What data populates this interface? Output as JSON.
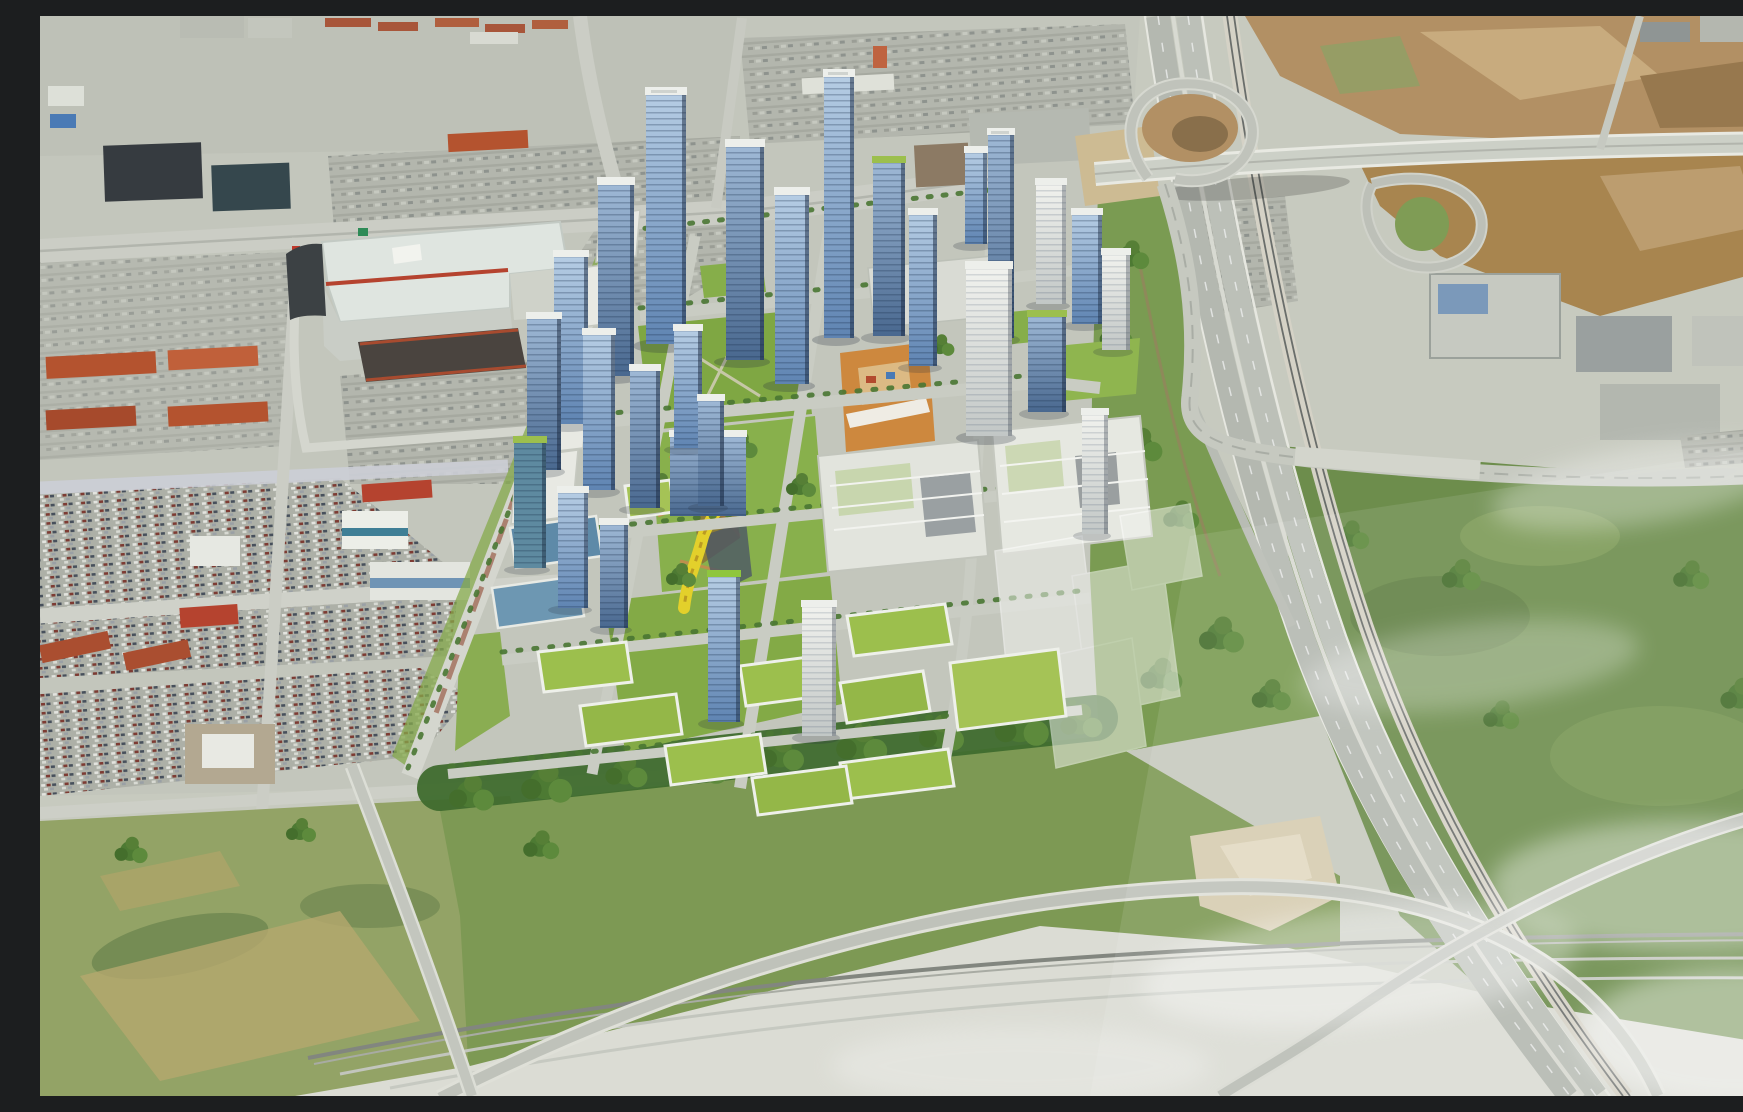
{
  "meta": {
    "title": "Aerial rendering of a transit-oriented master-planned tower development beside a freeway interchange",
    "alt": "Oblique summer aerial view: a photorealistic cluster of blue-glass condo towers, white podium slabs and green-roof mid-rises is composited onto suburban aerial photography. West of the site sit a large shopping mall with a mint roof and red-brick trim, big-box stores and car-filled dealership lots. East, a multi-lane freeway with a parallel rail line sweeps diagonally through loop ramps and brown graded fields. A pale concrete highway corridor with crossing flyover ramps runs along the bottom, with olive meadows lower-left and thin translucent clouds over the south-east."
  },
  "scene": {
    "time_of_day": "midday, summer",
    "style": "photorealistic 3D massing composited onto oblique aerial photo",
    "regions": [
      {
        "id": "suburban-retail-west",
        "label": "Existing suburban retail and parking fabric",
        "description": "Mall with mint roof and red-brick trim, dark big-box roofs, orange/red roofed plazas, dealership lots dense with cars"
      },
      {
        "id": "development-core",
        "label": "Proposed mixed-use development",
        "description": "Blue glass towers with white mechanical caps, long white podium slabs along a transit spine, green-roof mid-rises, central park with yellow ribbon path, orange event plaza with white canopy, translucent future-phase massing blocks"
      },
      {
        "id": "freeway-interchange-east",
        "label": "Freeway corridor and interchange",
        "description": "Twin carriageways plus rail line curving south-east, two loop ramps, arterial bridge, brown graded fields top-right, industrial roofs at right edge"
      },
      {
        "id": "highway-corridor-south",
        "label": "Pale highway corridor",
        "description": "Wide light-concrete corridor crossed by two flyover ramps forming an X"
      },
      {
        "id": "greenfields",
        "label": "Meadows and woodlots",
        "description": "Olive meadow lower-left, dense tree belt south of the site, scrub with sandy clearings near the freeway"
      },
      {
        "id": "clouds",
        "label": "Thin clouds",
        "description": "Wispy translucent cloud streaks over the south-east quadrant"
      }
    ],
    "landmarks": [
      {
        "id": "mall",
        "label": "Shopping mall with mint roof and red trim"
      },
      {
        "id": "orange-plaza",
        "label": "Orange event plaza with white canopy"
      },
      {
        "id": "yellow-ribbon",
        "label": "Yellow ribbon path in central park"
      },
      {
        "id": "tallest-tower",
        "label": "Tallest slender glass tower"
      },
      {
        "id": "loop-ramps",
        "label": "Interchange loop ramps"
      },
      {
        "id": "rail-line",
        "label": "Rail line beside freeway"
      },
      {
        "id": "flyover-x",
        "label": "Crossing flyover ramps"
      },
      {
        "id": "ghost-massing",
        "label": "Translucent future-phase blocks"
      }
    ],
    "palette": {
      "base": "#c7cabf",
      "road": "#c9ccc3",
      "freeway": "#b7bbb3",
      "corridor_pale": "#dbdcd4",
      "glass_blue": "#6f94bf",
      "glass_light": "#aac4de",
      "tower_cap": "#edefeb",
      "green_roof": "#9cbf4d",
      "lawn": "#84ab46",
      "tree": "#4e7c34",
      "orange_plaza": "#cd883e",
      "yellow_ribbon": "#e3d02b",
      "mall_roof": "#dfe5e0",
      "red_roof": "#b5432f",
      "dirt": "#a8854f",
      "olive_field": "#93a366"
    },
    "counts": {
      "towers": 26,
      "green_roof_midrises": 11,
      "ghost_blocks": 4,
      "loop_ramps": 2,
      "flyovers": 2
    }
  }
}
